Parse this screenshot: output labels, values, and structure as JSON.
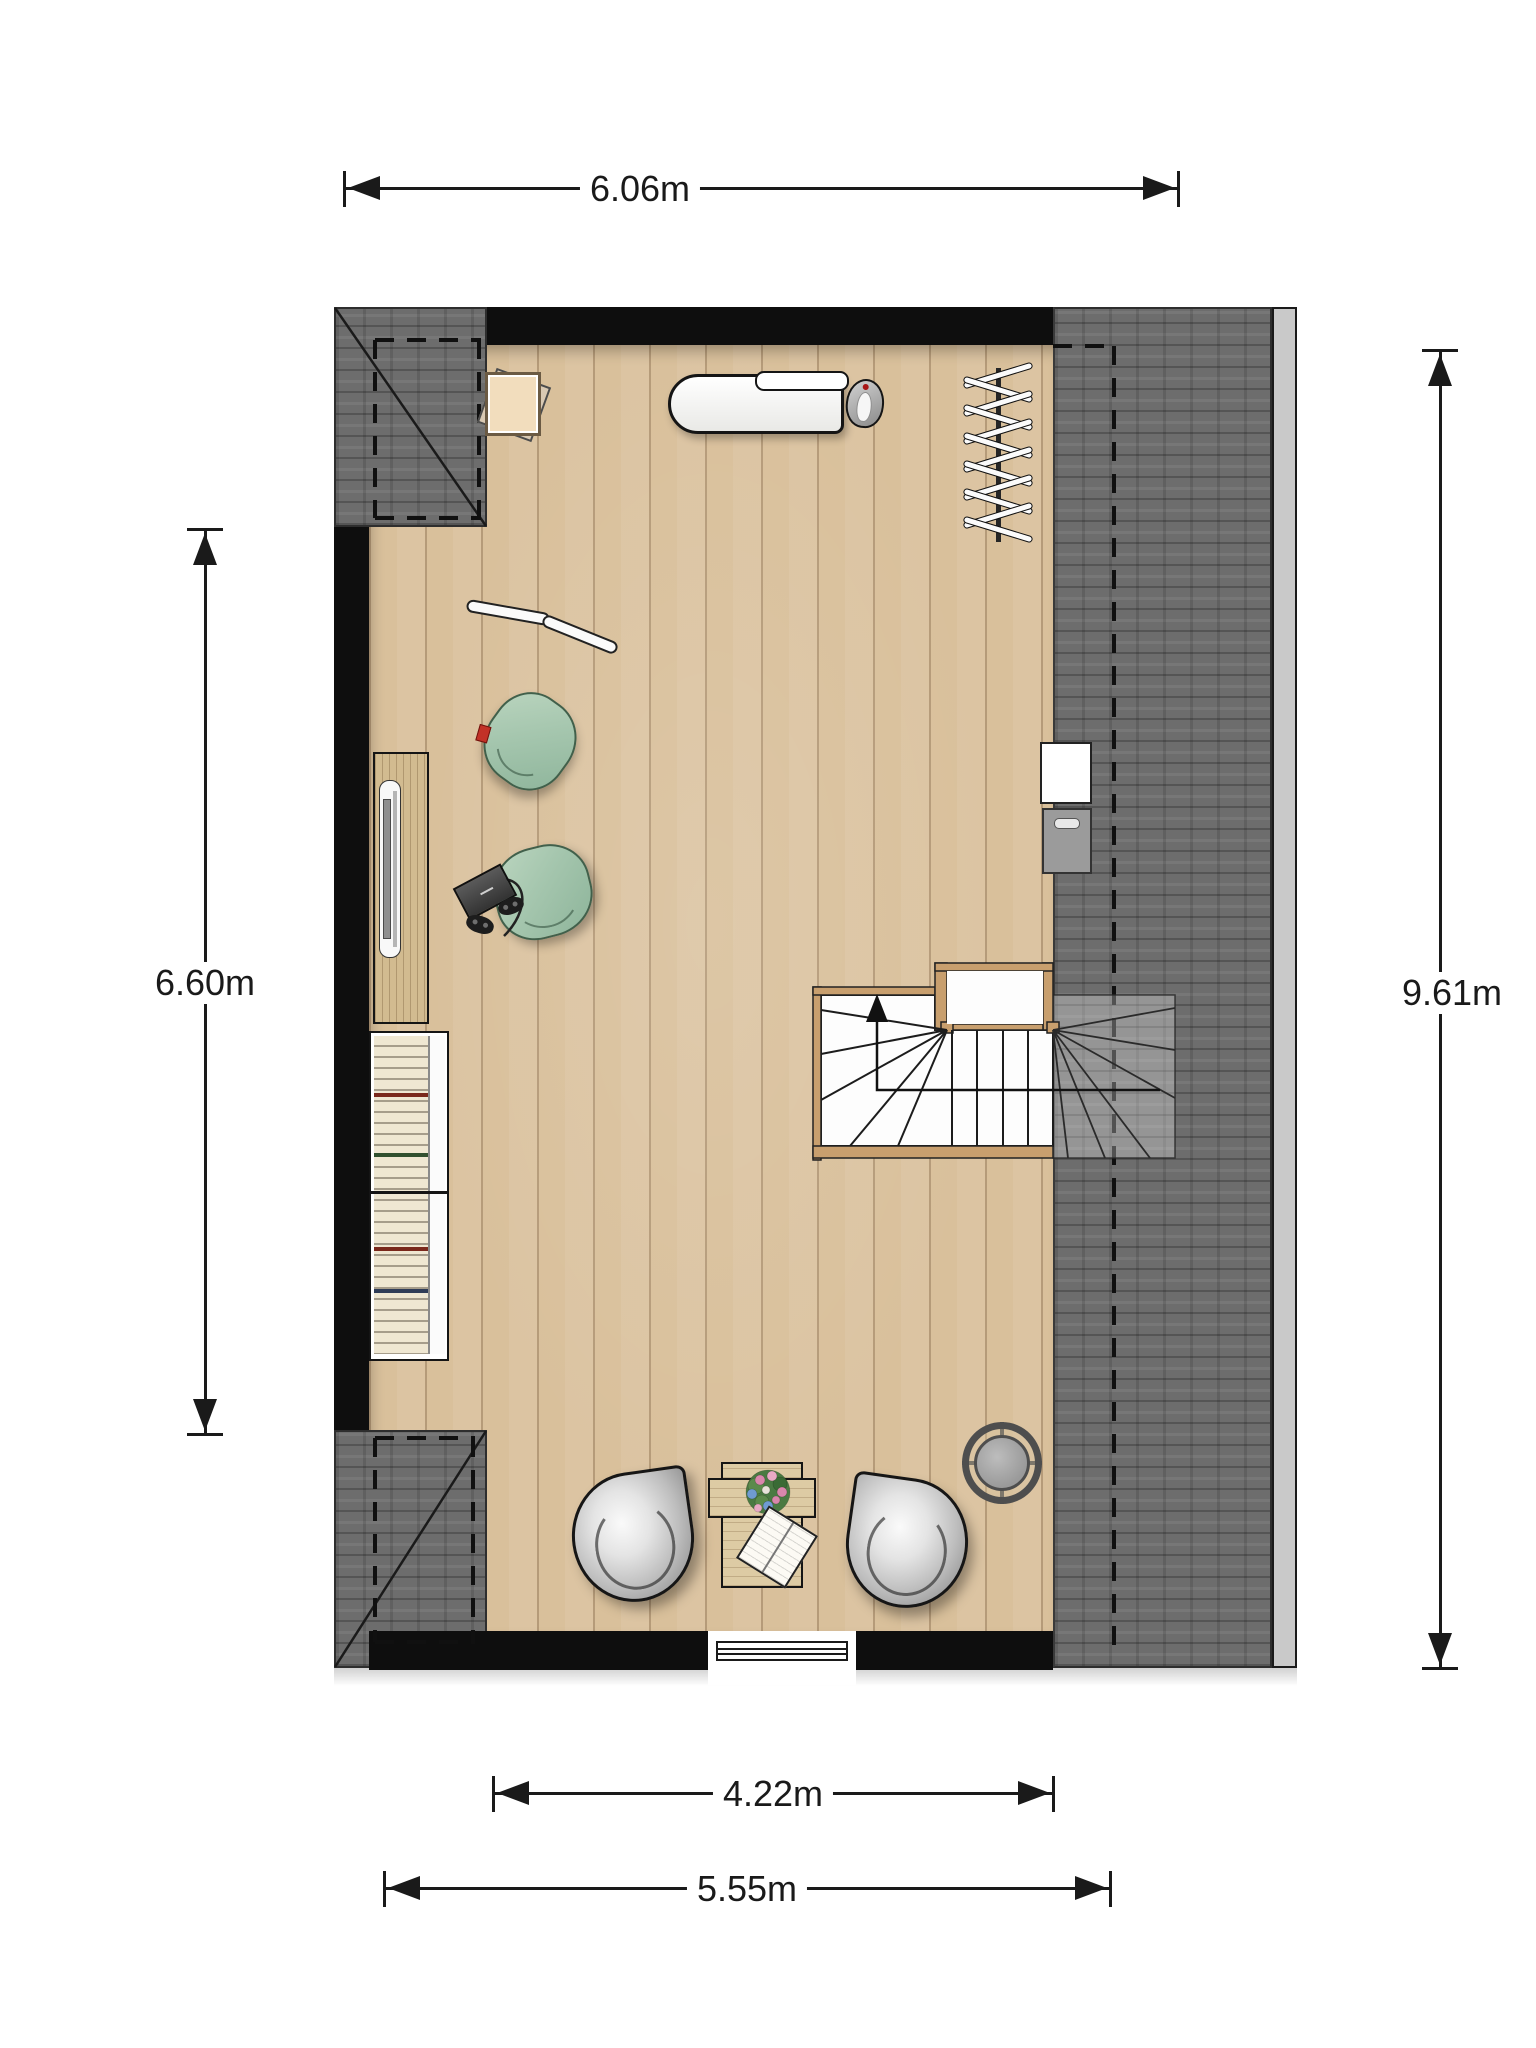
{
  "plan": {
    "type": "attic-floor-plan",
    "dimensions": {
      "top": "6.06m",
      "left": "6.60m",
      "right": "9.61m",
      "bottom_inner": "4.22m",
      "bottom_outer": "5.55m"
    },
    "colors": {
      "wall": "#0e0e0e",
      "roof_tiles": "#6d6d6d",
      "gutter": "#c9c9c9",
      "floor_wood": "#d9c09b",
      "stair_wood": "#c89f6e",
      "beanbag_green": "#a5c6ae",
      "accent_red_tag": "#c23127",
      "dimension_ink": "#1a1a1a"
    },
    "items": [
      "side-table",
      "ironing-board",
      "iron",
      "drying-rack",
      "curved-stick",
      "beanbag-1",
      "beanbag-2",
      "game-console",
      "game-controllers",
      "sideboard-with-tv",
      "bookshelf",
      "staircase-with-up-arrow",
      "chimney-cabinet",
      "chimney-flue",
      "egg-chair-left",
      "egg-chair-right",
      "coffee-table",
      "flower-bouquet",
      "open-book",
      "round-fan",
      "window"
    ]
  }
}
